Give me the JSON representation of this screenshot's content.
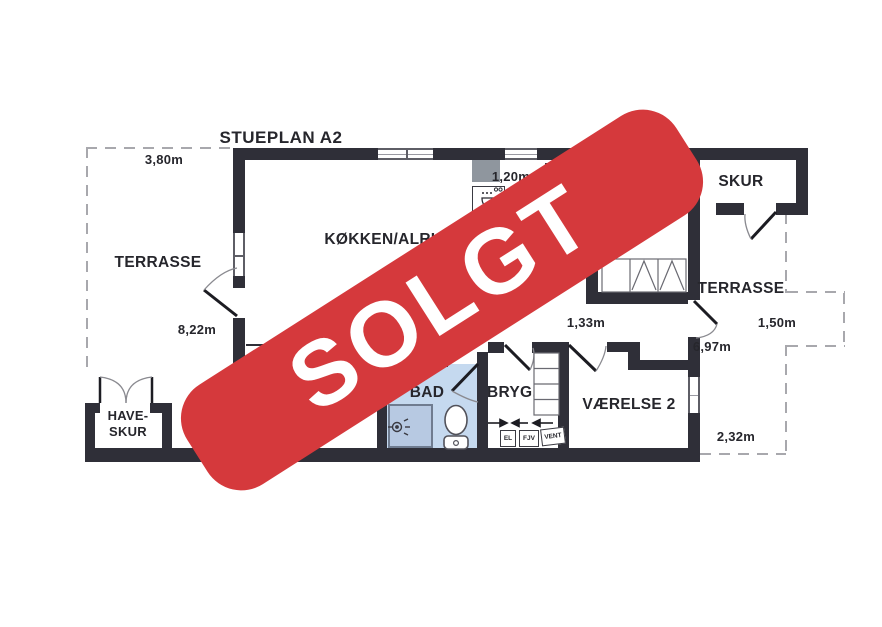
{
  "banner": {
    "text": "SOLGT"
  },
  "plan": {
    "title": "STUEPLAN A2",
    "labels": {
      "kitchen": "KØKKEN/ALRUM",
      "terrace_left": "TERRASSE",
      "terrace_right": "TERRASSE",
      "shed": "SKUR",
      "bath": "BAD",
      "utility_room": "BRYG.",
      "bedroom2": "VÆRELSE 2",
      "garden_shed_line1": "HAVE-",
      "garden_shed_line2": "SKUR"
    },
    "measurements": {
      "terrace_left_width": "3,80m",
      "kitchen_passage": "1,20m",
      "left_wall_length": "8,22m",
      "hall_opening": "1,33m",
      "terrace_bay": "1,50m",
      "right_wall_length": "6,97m",
      "terrace_right_width": "2,32m"
    },
    "utility_units": {
      "el": "EL",
      "fjv": "FJV",
      "vent": "VENT"
    },
    "colors": {
      "banner_red": "#d5393c",
      "wall": "#2f2f38",
      "bath_floor": "#c5d9ef",
      "shower_floor": "#b7c9e2"
    }
  }
}
